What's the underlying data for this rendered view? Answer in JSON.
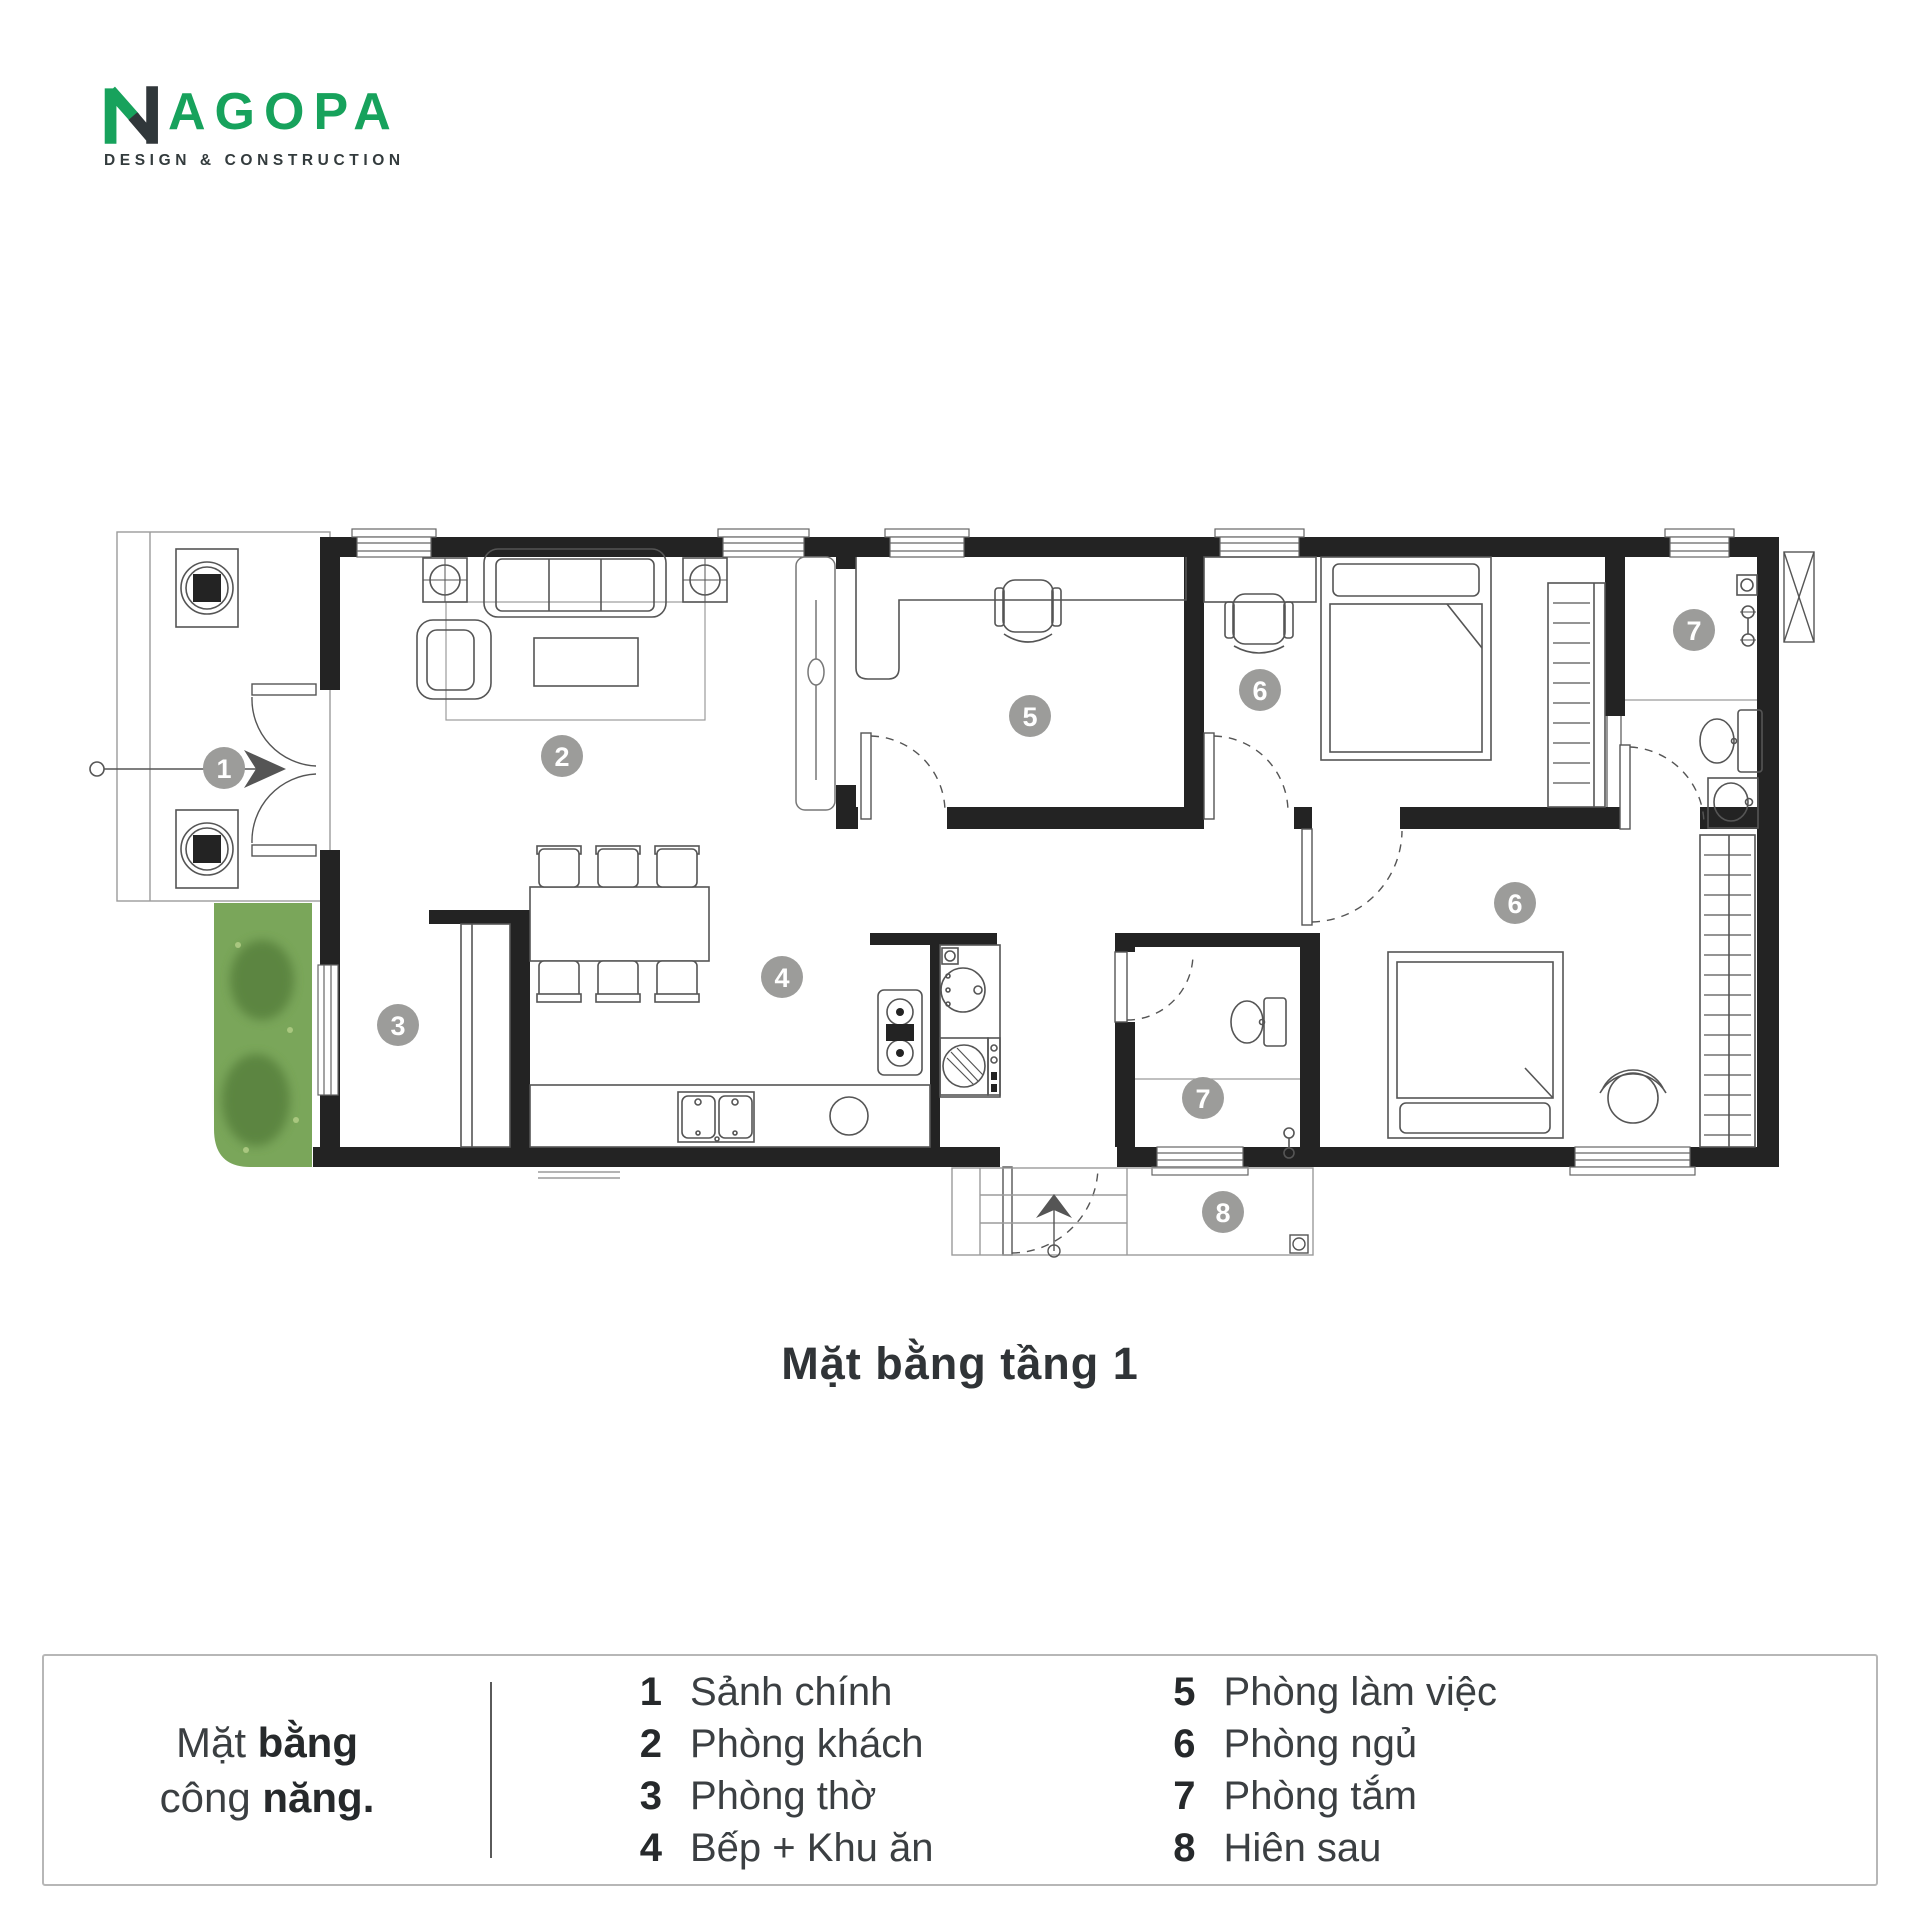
{
  "logo": {
    "brand_suffix": "AGOPA",
    "tagline": "DESIGN & CONSTRUCTION",
    "green": "#17a25c",
    "dark": "#30373a"
  },
  "plan": {
    "title": "Mặt bằng tầng 1",
    "wall_color": "#232323",
    "badge_color": "#9c9c9a",
    "grass_color": "#7aa65a",
    "badges": [
      {
        "n": "1",
        "x": 224,
        "y": 768
      },
      {
        "n": "2",
        "x": 562,
        "y": 756
      },
      {
        "n": "3",
        "x": 398,
        "y": 1025
      },
      {
        "n": "4",
        "x": 782,
        "y": 977
      },
      {
        "n": "5",
        "x": 1030,
        "y": 716
      },
      {
        "n": "6",
        "x": 1260,
        "y": 690
      },
      {
        "n": "6",
        "x": 1515,
        "y": 903
      },
      {
        "n": "7",
        "x": 1694,
        "y": 630
      },
      {
        "n": "7",
        "x": 1203,
        "y": 1098
      },
      {
        "n": "8",
        "x": 1223,
        "y": 1212
      }
    ]
  },
  "legend": {
    "heading": {
      "line1_regular": "Mặt",
      "line1_bold": "bằng",
      "line2_regular": "công",
      "line2_bold": "năng."
    },
    "columns": [
      [
        {
          "n": "1",
          "label": "Sảnh chính"
        },
        {
          "n": "2",
          "label": "Phòng khách"
        },
        {
          "n": "3",
          "label": "Phòng thờ"
        },
        {
          "n": "4",
          "label": "Bếp + Khu ăn"
        }
      ],
      [
        {
          "n": "5",
          "label": "Phòng làm việc"
        },
        {
          "n": "6",
          "label": "Phòng ngủ"
        },
        {
          "n": "7",
          "label": "Phòng tắm"
        },
        {
          "n": "8",
          "label": "Hiên sau"
        }
      ]
    ]
  }
}
